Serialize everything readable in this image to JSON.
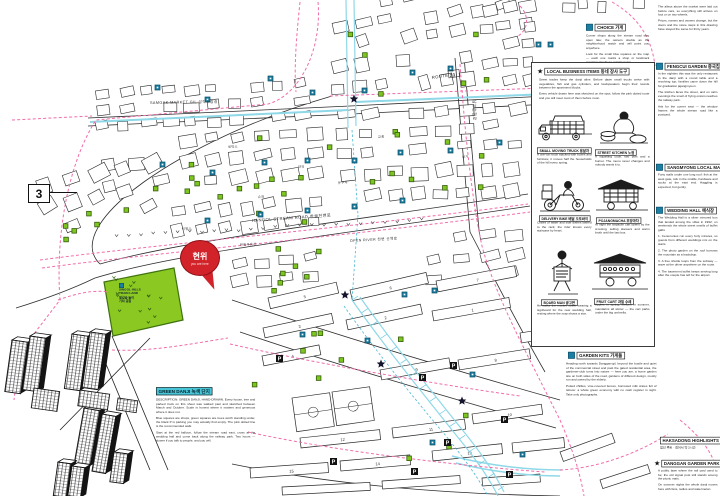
{
  "map": {
    "sheet_number": "3",
    "you_are_here": {
      "title": "현위",
      "subtitle": "you are here"
    },
    "park": {
      "lines": [
        "SINGOL HILLS",
        "TRAIN LAND",
        "철길숲 놀이",
        "기차 공원"
      ]
    },
    "road_labels": {
      "stream_road": "HANGOL STREAM ROAD 한골천변로",
      "route": "ROUTE",
      "route_no": "23",
      "vertical_road": "남부순환로",
      "top_road": "SAMGAK MARKET GIL 삼각시장길",
      "river_walk": "OPEN RIVER 천변 산책로"
    },
    "small_labels": [
      "세탁소",
      "약국",
      "슈퍼",
      "교회",
      "한일부동산",
      "상가",
      "이발소",
      "문구사"
    ],
    "parking_label": "P"
  },
  "panels": {
    "top_note": {
      "title": "CHOICE 가게",
      "body": [
        "Corner shops along the stream road stay open late; the owners double as the neighborhood watch and will point you anywhere.",
        "Look for the small blue squares on the map — each one marks a shop or landmark mentioned in these margin notes."
      ]
    },
    "business": {
      "title": "LOCAL BUSINESS ITEMS 동네 장사 도구",
      "intro": [
        "Street trades keep the danji alive. Before dawn small trucks arrive with vegetables, fish and gas cylinders, and loudspeakers begin their rounds between the apartment blocks.",
        "Every vehicle drawn here was sketched on the spot; follow the pink dotted route and you will meet most of them before noon."
      ],
      "items": [
        {
          "label": "SMALL MOVING TRUCK 용달차",
          "caption": "A one-ton truck stacked with boxes and furniture; it moves half the households of the hill every spring."
        },
        {
          "label": "STREET KITCHEN 노점",
          "caption": "A squatting cook, two pots and a burner. The menu never changes and nobody wants it to."
        },
        {
          "label": "DELIVERY BIKE 배달 오토바이",
          "caption": "Crates of water and side dishes lashed to the rack; the rider knows every staircase by heart."
        },
        {
          "label": "POJANGMACHA 포장마차",
          "caption": "At night the tarpaulin cart opens by the crossing, selling skewers and warm broth until the last bus."
        },
        {
          "label": "BOARD MAN 광고판",
          "caption": "He walks the market street wearing a signboard for the new wedding hall, resting where the map shows a star."
        },
        {
          "label": "FRUIT CART 과일 수레",
          "caption": "Apples in spring, melons in summer, mandarins all winter — the cart parks under the big umbrella."
        }
      ]
    },
    "right_column": {
      "top_body": [
        "The alleys above the market were laid out before cars, so everything still arrives on foot or on two wheels.",
        "Prices, names and owners change, but the doors and the stone steps in this drawing have stayed the same for thirty years."
      ],
      "sections": [
        {
          "title": "FENGCUI GARDEN 중국집",
          "body": [
            "In the eighties this was the only restaurant in the danji with a round table and a revolving top; families came down the hill for graduation jajangmyeon.",
            "The kitchen faces the street, and on calm evenings the smell of frying onions reaches the railway park.",
            "Ask for the corner seat — the window frames the whole stream road like a postcard."
          ]
        },
        {
          "title": "SANGMYONG LOCAL MARKET 재래시장",
          "body": [
            "Forty stalls under one long roof: fish at the west gate, tofu in the middle, hardware and socks at the east end. Haggling is expected, but gently."
          ]
        },
        {
          "title": "WEDDING HALL 예식장",
          "body": [
            "The Wedding Hall is a silver mirrored box that landed among the villas in 1992; on weekends the whole street smells of buffet galbi.",
            "1. Ceremonies run every forty minutes, so guests from different weddings mix on the stairs.",
            "2. The photo garden on the roof borrows the mountain as a backdrop.",
            "3. A free shuttle loops from the subway — wave at the driver anywhere on the route.",
            "4. The basement buffet keeps serving long after the couple has left for the airport."
          ]
        }
      ],
      "highlights": {
        "title": "HAKSADONG HIGHLIGHTS 명소",
        "body": [
          "점선 루트 · 걸어서 약 2시간"
        ]
      },
      "park_section": {
        "title": "DANGGAN GARDEN PARK 공원",
        "body": [
          "A public lawn where the rail yard used to be; the old signal post still stands among the picnic mats.",
          "On summer nights the whole danji moves here with fans, radios and watermelon."
        ]
      }
    },
    "garden_kits": {
      "title": "GARDEN KITS 가게들",
      "body": [
        "Heading north towards Danggan-gil, beyond the bustle and quiet of the commercial street and past the gated residential area, the gardener-club turns into nature — here you are, a home garden site on both sides of the road, gardens of different design, mostly run and owned by the elderly.",
        "Potted chillies, vine-covered fences, borrowed milk crates full of lettuce: a whole green economy with no cash register in sight. Take only photographs."
      ]
    },
    "danji_note": {
      "title": "GREEN DANJI 녹색 단지",
      "body": [
        "DESCRIPTION: GREEN DANJI, HAND-DRAWN. Every house, tree and parked truck on this sheet was walked past and sketched between March and October. Scale is honest where it matters and generous where it does not.",
        "Blue squares are shops, green squares are trees worth standing under, the black P is parking you may actually find empty. The pink dotted line is the recommended walk.",
        "Start at the red balloon, follow the stream road east, cross at the wedding hall and come back along the railway park. Two hours — slower if you talk to people, and you will."
      ]
    }
  }
}
